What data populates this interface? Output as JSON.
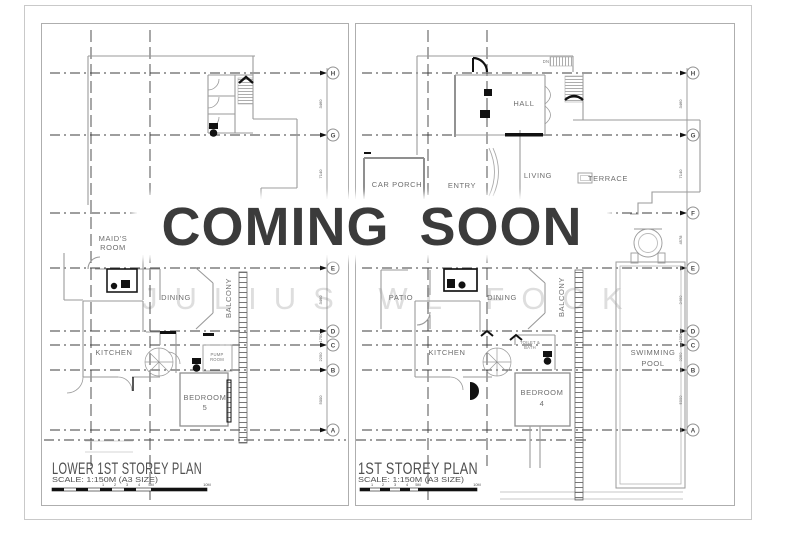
{
  "overlay": {
    "text": "COMING SOON"
  },
  "watermark": {
    "text": "JULIUS WL FOCK"
  },
  "colors": {
    "overlay_text": "#3b3b3b",
    "watermark_text": "#dedede",
    "wall_line": "#9a9a9a",
    "grid_line": "#3d3d3d",
    "fixture_fill": "#111111"
  },
  "plans": [
    {
      "title": "LOWER 1ST STOREY PLAN",
      "scale": "SCALE: 1:150M (A3 SIZE)",
      "scale_ticks": [
        "1",
        "2",
        "3",
        "4",
        "5M",
        "10M"
      ],
      "grid": [
        {
          "label": "H"
        },
        {
          "label": "G"
        },
        {
          "label": "E"
        },
        {
          "label": "D"
        },
        {
          "label": "C"
        },
        {
          "label": "B"
        },
        {
          "label": "A"
        }
      ],
      "dims": [
        "3460",
        "7140",
        "3460",
        "1750",
        "2250",
        "5000"
      ],
      "labels": {
        "maids_room_line1": "MAID'S",
        "maids_room_line2": "ROOM",
        "dining": "DINING",
        "balcony": "BALCONY",
        "kitchen": "KITCHEN",
        "pump_room_line1": "PUMP",
        "pump_room_line2": "ROOM",
        "bedroom_line1": "BEDROOM",
        "bedroom_line2": "5"
      }
    },
    {
      "title": "1ST STOREY PLAN",
      "scale": "SCALE: 1:150M (A3 SIZE)",
      "scale_ticks": [
        "1",
        "2",
        "3",
        "4",
        "5M",
        "10M"
      ],
      "grid": [
        {
          "label": "H"
        },
        {
          "label": "G"
        },
        {
          "label": "F"
        },
        {
          "label": "E"
        },
        {
          "label": "D"
        },
        {
          "label": "C"
        },
        {
          "label": "B"
        },
        {
          "label": "A"
        }
      ],
      "dims": [
        "3460",
        "7140",
        "4578",
        "3460",
        "1250",
        "3250",
        "5000"
      ],
      "labels": {
        "car_porch": "CAR PORCH",
        "entry": "ENTRY",
        "hall": "HALL",
        "living": "LIVING",
        "terrace": "TERRACE",
        "stair_direction": "DN",
        "patio": "PATIO",
        "dining": "DINING",
        "balcony": "BALCONY",
        "kitchen": "KITCHEN",
        "toilet_line1": "TOILET &",
        "toilet_line2": "BATH",
        "bedroom_line1": "BEDROOM",
        "bedroom_line2": "4",
        "pool_line1": "SWIMMING",
        "pool_line2": "POOL"
      }
    }
  ]
}
